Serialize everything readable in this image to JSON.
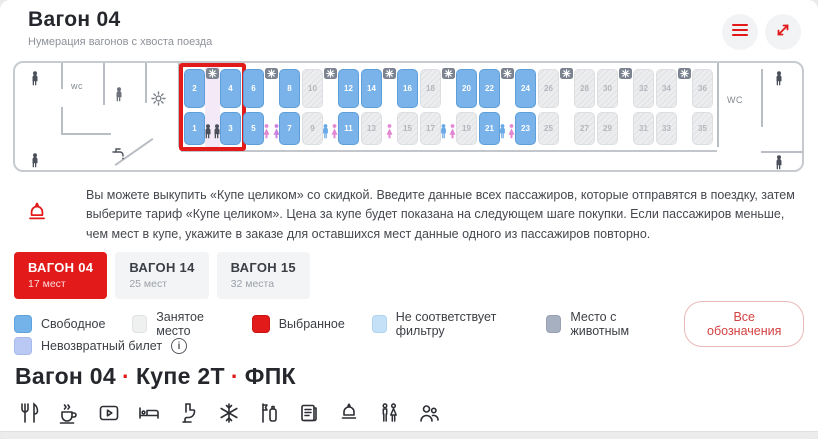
{
  "header": {
    "title": "Вагон 04",
    "subtitle": "Нумерация вагонов с хвоста поезда"
  },
  "car_map": {
    "wc_left": "wc",
    "wc_right": "WC",
    "compartments": [
      {
        "highlighted": true,
        "gender": "pair-dark",
        "seats": {
          "top": [
            {
              "num": "2",
              "state": "free"
            },
            {
              "num": "4",
              "state": "free"
            }
          ],
          "bottom": [
            {
              "num": "1",
              "state": "free"
            },
            {
              "num": "3",
              "state": "free"
            }
          ]
        }
      },
      {
        "highlighted": false,
        "gender": "pair-female",
        "seats": {
          "top": [
            {
              "num": "6",
              "state": "free"
            },
            {
              "num": "8",
              "state": "free"
            }
          ],
          "bottom": [
            {
              "num": "5",
              "state": "free"
            },
            {
              "num": "7",
              "state": "free"
            }
          ]
        }
      },
      {
        "highlighted": false,
        "gender": "pair-mixed",
        "seats": {
          "top": [
            {
              "num": "10",
              "state": "occupied"
            },
            {
              "num": "12",
              "state": "free"
            }
          ],
          "bottom": [
            {
              "num": "9",
              "state": "occupied"
            },
            {
              "num": "11",
              "state": "free"
            }
          ]
        }
      },
      {
        "highlighted": false,
        "gender": "female",
        "seats": {
          "top": [
            {
              "num": "14",
              "state": "free"
            },
            {
              "num": "16",
              "state": "free"
            }
          ],
          "bottom": [
            {
              "num": "13",
              "state": "occupied"
            },
            {
              "num": "15",
              "state": "occupied"
            }
          ]
        }
      },
      {
        "highlighted": false,
        "gender": "pair-mixed",
        "seats": {
          "top": [
            {
              "num": "18",
              "state": "occupied"
            },
            {
              "num": "20",
              "state": "free"
            }
          ],
          "bottom": [
            {
              "num": "17",
              "state": "occupied"
            },
            {
              "num": "19",
              "state": "occupied"
            }
          ]
        }
      },
      {
        "highlighted": false,
        "gender": "pair-mixed",
        "seats": {
          "top": [
            {
              "num": "22",
              "state": "free"
            },
            {
              "num": "24",
              "state": "free"
            }
          ],
          "bottom": [
            {
              "num": "21",
              "state": "free"
            },
            {
              "num": "23",
              "state": "free"
            }
          ]
        }
      },
      {
        "highlighted": false,
        "gender": "none",
        "seats": {
          "top": [
            {
              "num": "26",
              "state": "occupied"
            },
            {
              "num": "28",
              "state": "occupied"
            }
          ],
          "bottom": [
            {
              "num": "25",
              "state": "occupied"
            },
            {
              "num": "27",
              "state": "occupied"
            }
          ]
        }
      },
      {
        "highlighted": false,
        "gender": "none",
        "seats": {
          "top": [
            {
              "num": "30",
              "state": "occupied"
            },
            {
              "num": "32",
              "state": "occupied"
            }
          ],
          "bottom": [
            {
              "num": "29",
              "state": "occupied"
            },
            {
              "num": "31",
              "state": "occupied"
            }
          ]
        }
      },
      {
        "highlighted": false,
        "gender": "none",
        "seats": {
          "top": [
            {
              "num": "34",
              "state": "occupied"
            },
            {
              "num": "36",
              "state": "occupied"
            }
          ],
          "bottom": [
            {
              "num": "33",
              "state": "occupied"
            },
            {
              "num": "35",
              "state": "occupied"
            }
          ]
        }
      }
    ]
  },
  "notice": {
    "text": "Вы можете выкупить «Купе целиком» со скидкой. Введите данные всех пассажиров, которые отправятся в поездку, затем выберите тариф «Купе целиком». Цена за купе будет показана на следующем шаге покупки. Если пассажиров меньше, чем мест в купе, укажите в заказе для оставшихся мест данные одного из пассажиров повторно."
  },
  "wagon_tabs": [
    {
      "label": "ВАГОН 04",
      "seats": "17 мест",
      "active": true
    },
    {
      "label": "ВАГОН 14",
      "seats": "25 мест",
      "active": false
    },
    {
      "label": "ВАГОН 15",
      "seats": "32 места",
      "active": false
    }
  ],
  "legend": {
    "items": [
      {
        "name": "free",
        "label": "Свободное",
        "color": "#74b3ea",
        "border": "#5ea2df"
      },
      {
        "name": "occupied",
        "label": "Занятое место",
        "color": "#eff0f0",
        "border": "#e0e2e4"
      },
      {
        "name": "selected",
        "label": "Выбранное",
        "color": "#e21a1a",
        "border": "#c91515"
      },
      {
        "name": "filter-mismatch",
        "label": "Не соответствует фильтру",
        "color": "#c5e1f8",
        "border": "#b0d3ef"
      },
      {
        "name": "with-animal",
        "label": "Место с животным",
        "color": "#a6b0c0",
        "border": "#96a1b2"
      }
    ],
    "all_labels_button": "Все обозначения",
    "nonrefundable": {
      "label": "Невозвратный билет",
      "color": "#b9c9f4",
      "border": "#a6b9ec",
      "info": "i"
    }
  },
  "car_class": {
    "heading_parts": [
      "Вагон 04",
      "Купе 2Т",
      "ФПК"
    ],
    "separator": "·",
    "amenities": [
      "restaurant",
      "tea",
      "media",
      "bed",
      "toilet",
      "air-conditioning",
      "hygiene-kit",
      "press",
      "discount",
      "wc-mf",
      "passengers"
    ]
  },
  "colors": {
    "accent": "#e21a1a",
    "seat_free": "#79b3e9",
    "seat_occupied": "#ecedee"
  }
}
